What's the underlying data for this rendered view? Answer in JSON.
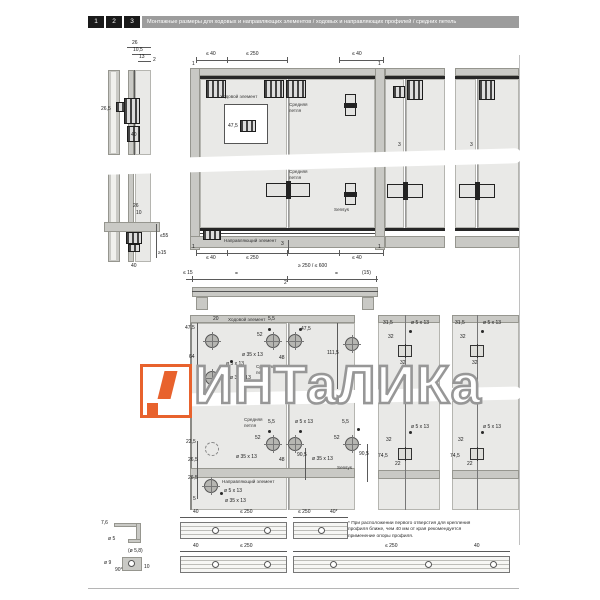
{
  "header": {
    "steps": [
      "1",
      "2",
      "3"
    ],
    "title": "Монтажные размеры для ходовых и направляющих элементов / ходовых и направляющих профилей / средних петель",
    "bar_color": "#9c9c9c",
    "step_bg": "#1a1a1a"
  },
  "watermark": {
    "text": "ИНТаЛИКа",
    "orange": "#e8622d",
    "gray": "#979797"
  },
  "side_top": {
    "d1": "26",
    "d2": "10,5",
    "d3": "13",
    "d4": "2",
    "d5": "26,5",
    "d6": "40"
  },
  "side_bot": {
    "d1": "26",
    "d2": "10",
    "d3": "≤55",
    "d4": "≥15",
    "d5": "40"
  },
  "front": {
    "t1": "1",
    "t2": "≤ 40",
    "t3": "≤ 250",
    "t4": "≤ 40",
    "t5": "1",
    "running": "Ходовой элемент",
    "hinge_a1": "Средняя",
    "hinge_a2": "петля",
    "hinge_b1": "Средняя",
    "hinge_b2": "петля",
    "sensys": "Sensys",
    "detail": "47,5",
    "gap1": "3",
    "gap2": "3",
    "gap3": "3",
    "guide": "Направляющий элемент",
    "b1": "1",
    "b2": "≤ 40",
    "b3": "≤ 250",
    "b4": "≤ 40",
    "b5": "1",
    "span": "≥ 250 / ≤ 600"
  },
  "profile": {
    "d1": "≤ 15",
    "d2": "=",
    "d3": "2",
    "d4": "=",
    "d5": "(15)"
  },
  "drill": {
    "running": "Ходовой элемент",
    "hinge_a1": "Средняя",
    "hinge_a2": "петля",
    "hinge_b1": "Средняя",
    "hinge_b2": "петля",
    "sensys": "Sensys",
    "guide": "Направляющий элемент",
    "u_475a": "47,5",
    "u_20": "20",
    "u_55": "5,5",
    "u_52": "52",
    "u_475b": "47,5",
    "u_1115": "111,5",
    "u_64": "64",
    "u_d5": "ø 5 x 13",
    "u_d35a": "ø 35 x 13",
    "u_d35b": "ø 35 x 13",
    "u_48": "48",
    "l_55a": "5,5",
    "l_52a": "52",
    "l_d5a": "ø 5 x 13",
    "l_d35a": "ø 35 x 13",
    "l_48": "48",
    "l_905a": "90,5",
    "l_55b": "5,5",
    "l_52b": "52",
    "l_d35b": "ø 35 x 13",
    "l_905b": "90,5",
    "e_225": "22,5",
    "e_265a": "26,5",
    "e_265b": "26,5",
    "e_5": "5",
    "e_d5": "ø 5 x 13",
    "e_d35": "ø 35 x 13"
  },
  "col1": {
    "t1": "31,5",
    "t2": "32",
    "t3": "ø 5 x 13",
    "t4": "32",
    "b1": "32",
    "b2": "74,5",
    "b3": "22",
    "b4": "ø 5 x 13"
  },
  "col2": {
    "t1": "31,5",
    "t2": "32",
    "t3": "ø 5 x 13",
    "t4": "32",
    "b1": "32",
    "b2": "74,5",
    "b3": "22",
    "b4": "ø 5 x 13"
  },
  "strips": {
    "s1_76": "7,6",
    "s1_d5": "ø 5",
    "r1_40": "40",
    "r1_250": "≤ 250",
    "r1_250b": "≤ 250",
    "r1_40b": "40*",
    "s2_58": "(ø 5,8)",
    "s2_d9": "ø 9",
    "s2_90": "90°",
    "s2_10": "10",
    "r2_40": "40",
    "r2_250": "≤ 250",
    "r2_250b": "≤ 250",
    "r2_40b": "40"
  },
  "footnote": "* При расположении первого отверстия для крепления профиля ближе, чем 40 мм от края рекомендуется применение опоры профиля."
}
